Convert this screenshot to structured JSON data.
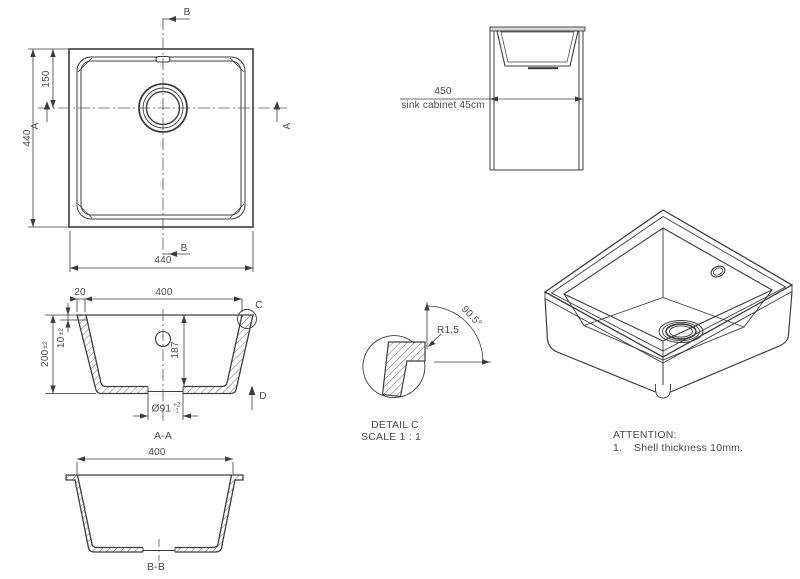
{
  "colors": {
    "line": "#3d3d3d",
    "text": "#4a4a4a",
    "background": "#ffffff",
    "countertop_fill": "#d8d8d8"
  },
  "views": {
    "top": {
      "section_b": "B",
      "section_a": "A",
      "dim_width_bottom": "440",
      "dim_height_left": "440",
      "dim_drain_center": "150"
    },
    "cabinet": {
      "dim_width": "450",
      "caption": "sink cabinet 45cm"
    },
    "section_aa": {
      "title": "A-A",
      "dim_rim_width": "20",
      "dim_opening_width": "400",
      "dim_wall_thickness": "10",
      "dim_wall_tol": "±2",
      "dim_total_height": "200",
      "dim_total_height_tol": "±2",
      "dim_inner_depth": "187",
      "dim_drain_diameter": "Ø91",
      "dim_drain_tol_plus": "+2",
      "dim_drain_tol_minus": "-1",
      "detail_marker": "C",
      "direction_marker": "D"
    },
    "detail_c": {
      "title": "DETAIL C",
      "scale": "SCALE 1 : 1",
      "radius": "R1,5",
      "angle": "90.5°"
    },
    "section_bb": {
      "title": "B-B",
      "dim_opening_width": "400"
    }
  },
  "notes": {
    "heading": "ATTENTION:",
    "item_number": "1.",
    "item_text": "Shell thickness 10mm."
  }
}
